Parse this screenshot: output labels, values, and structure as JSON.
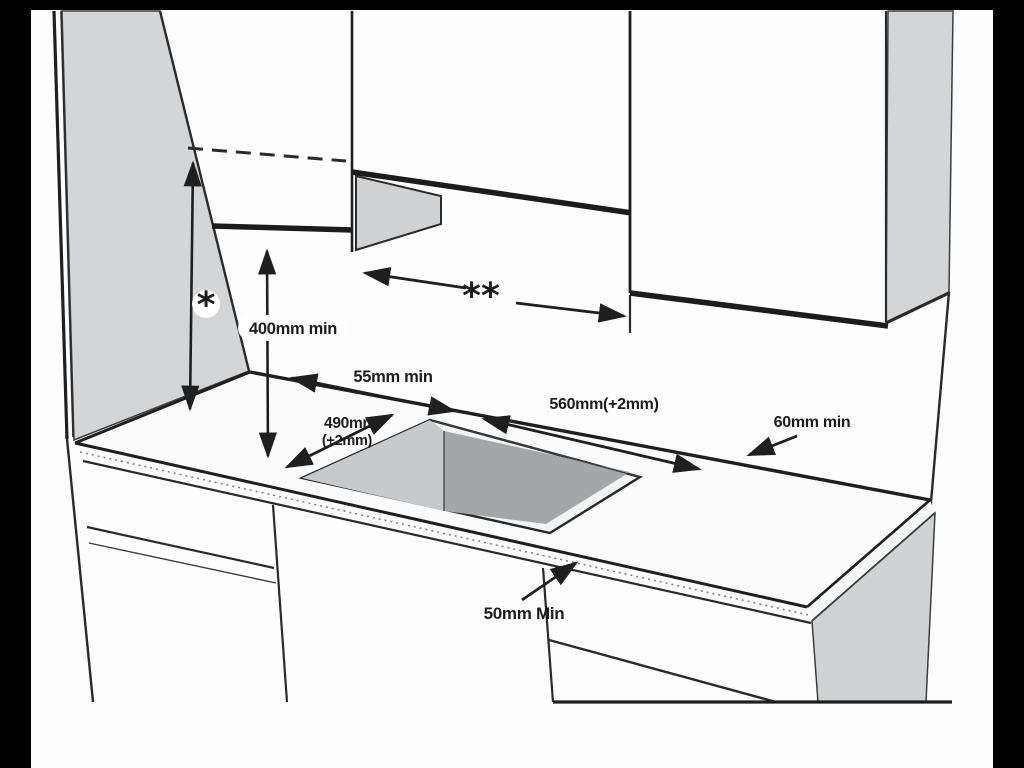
{
  "diagram": {
    "kind": "hob-installation-clearance-drawing",
    "labels": {
      "star": "*",
      "double_star": "**",
      "cabinet_clearance": "400mm min",
      "rear_clearance": "55mm min",
      "cutout_width": "560mm(+2mm)",
      "cutout_depth": "490mm",
      "cutout_depth_tol": "(+2mm)",
      "side_clearance": "60mm min",
      "front_clearance": "50mm Min"
    },
    "colors": {
      "frame": "#000000",
      "background": "#ffffff",
      "line": "#222222",
      "cabinet_side_panel": "#d3d5d7",
      "cutout_wall": "#c7cacc",
      "cutout_floor": "#a3a7a9",
      "base_end_panel": "#d0d2d4"
    }
  }
}
